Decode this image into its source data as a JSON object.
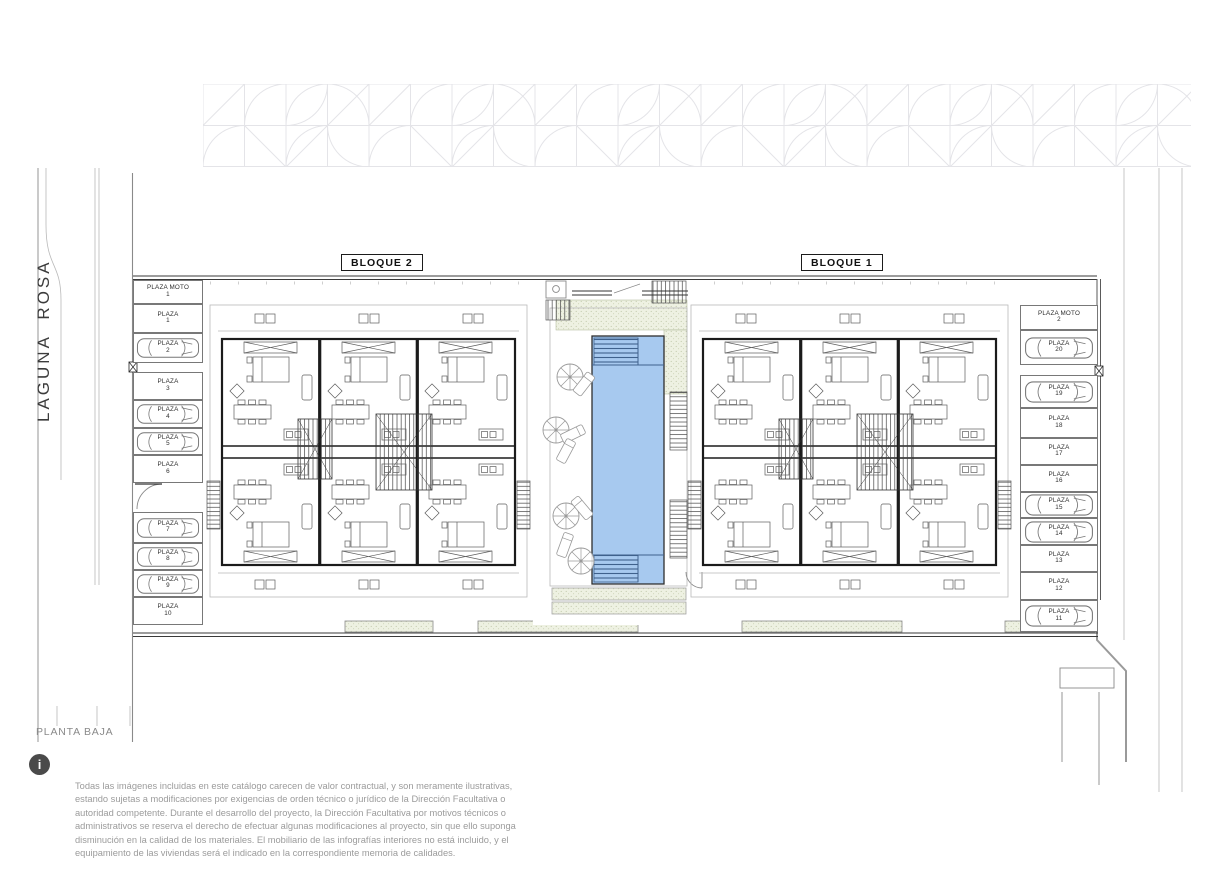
{
  "street": {
    "name": "LAGUNA  ROSA"
  },
  "plan": {
    "title": "PLANTA BAJA"
  },
  "blocks": {
    "block1_label": "BLOQUE 1",
    "block2_label": "BLOQUE 2"
  },
  "pool": {
    "present": true,
    "shape": "rectangular",
    "fill": "#a7c9ef"
  },
  "parking_left": [
    {
      "label": "PLAZA MOTO",
      "number": "1",
      "car": false
    },
    {
      "label": "PLAZA",
      "number": "1",
      "car": false
    },
    {
      "label": "PLAZA",
      "number": "2",
      "car": true
    },
    {
      "label": "PLAZA",
      "number": "3",
      "car": false
    },
    {
      "label": "PLAZA",
      "number": "4",
      "car": true
    },
    {
      "label": "PLAZA",
      "number": "5",
      "car": true
    },
    {
      "label": "PLAZA",
      "number": "6",
      "car": false
    },
    {
      "label": "PLAZA",
      "number": "7",
      "car": true
    },
    {
      "label": "PLAZA",
      "number": "8",
      "car": true
    },
    {
      "label": "PLAZA",
      "number": "9",
      "car": true
    },
    {
      "label": "PLAZA",
      "number": "10",
      "car": false
    }
  ],
  "parking_right": [
    {
      "label": "PLAZA MOTO",
      "number": "2",
      "car": false
    },
    {
      "label": "PLAZA",
      "number": "20",
      "car": true
    },
    {
      "label": "PLAZA",
      "number": "19",
      "car": true
    },
    {
      "label": "PLAZA",
      "number": "18",
      "car": false
    },
    {
      "label": "PLAZA",
      "number": "17",
      "car": false
    },
    {
      "label": "PLAZA",
      "number": "16",
      "car": false
    },
    {
      "label": "PLAZA",
      "number": "15",
      "car": true
    },
    {
      "label": "PLAZA",
      "number": "14",
      "car": true
    },
    {
      "label": "PLAZA",
      "number": "13",
      "car": false
    },
    {
      "label": "PLAZA",
      "number": "12",
      "car": false
    },
    {
      "label": "PLAZA",
      "number": "11",
      "car": true
    }
  ],
  "info": {
    "icon_glyph": "i",
    "disclaimer": "Todas las imágenes incluidas en este catálogo carecen de valor contractual, y son meramente ilustrativas, estando sujetas a modificaciones por exigencias de  orden técnico o jurídico de la Dirección Facultativa o autoridad competente. Durante el desarrollo del proyecto, la Dirección Facultativa por motivos técnicos o administrativos se reserva el derecho de efectuar algunas modificaciones al proyecto, sin que ello suponga disminución  en la calidad de los materiales. El mobiliario de las infografías interiores no está incluido, y el equipamiento de las viviendas será el indicado en la correspondiente memoria de calidades."
  },
  "colors": {
    "pool_fill": "#a7c9ef",
    "pool_lines": "#3f618c",
    "lawn_fill": "#eef1e2",
    "wall": "#1b1b1b",
    "light_line": "#b9b9b9",
    "text_gray": "#9b9b9b"
  }
}
